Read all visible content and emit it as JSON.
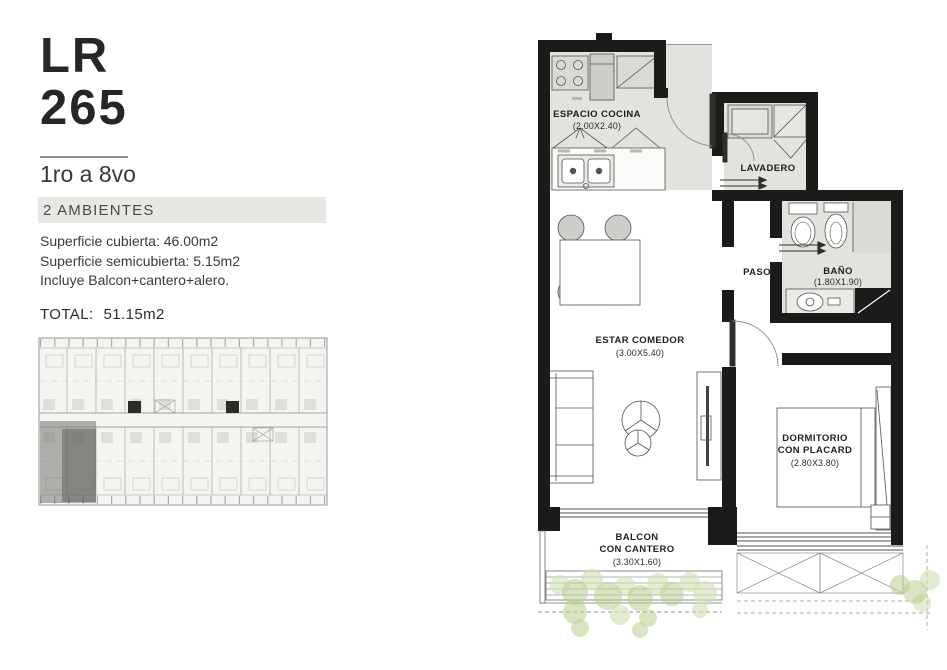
{
  "panel": {
    "unit_code": "LR",
    "unit_number": "265",
    "floors": "1ro a 8vo",
    "type_banner": "2 AMBIENTES",
    "surface_lines": [
      "Superficie cubierta: 46.00m2",
      "Superficie semicubierta: 5.15m2",
      "Incluye Balcon+cantero+alero."
    ],
    "total_label": "TOTAL:",
    "total_value": "51.15m2"
  },
  "plan": {
    "rooms": {
      "kitchen": {
        "name": "ESPACIO COCINA",
        "dims": "(2.00X2.40)"
      },
      "laundry": {
        "name": "LAVADERO"
      },
      "hall": {
        "name": "PASO"
      },
      "bath": {
        "name": "BAÑO",
        "dims": "(1.80X1.90)"
      },
      "living": {
        "name": "ESTAR COMEDOR",
        "dims": "(3.00X5.40)"
      },
      "bedroom": {
        "name1": "DORMITORIO",
        "name2": "CON PLACARD",
        "dims": "(2.80X3.80)"
      },
      "balcony": {
        "name1": "BALCON",
        "name2": "CON CANTERO",
        "dims": "(3.30X1.60)"
      }
    }
  },
  "colors": {
    "wall": "#1b1b19",
    "floor_tint": "#e4e2de",
    "plant_green": "#b9d08f",
    "keyplan_highlight": "#6f6d68"
  }
}
